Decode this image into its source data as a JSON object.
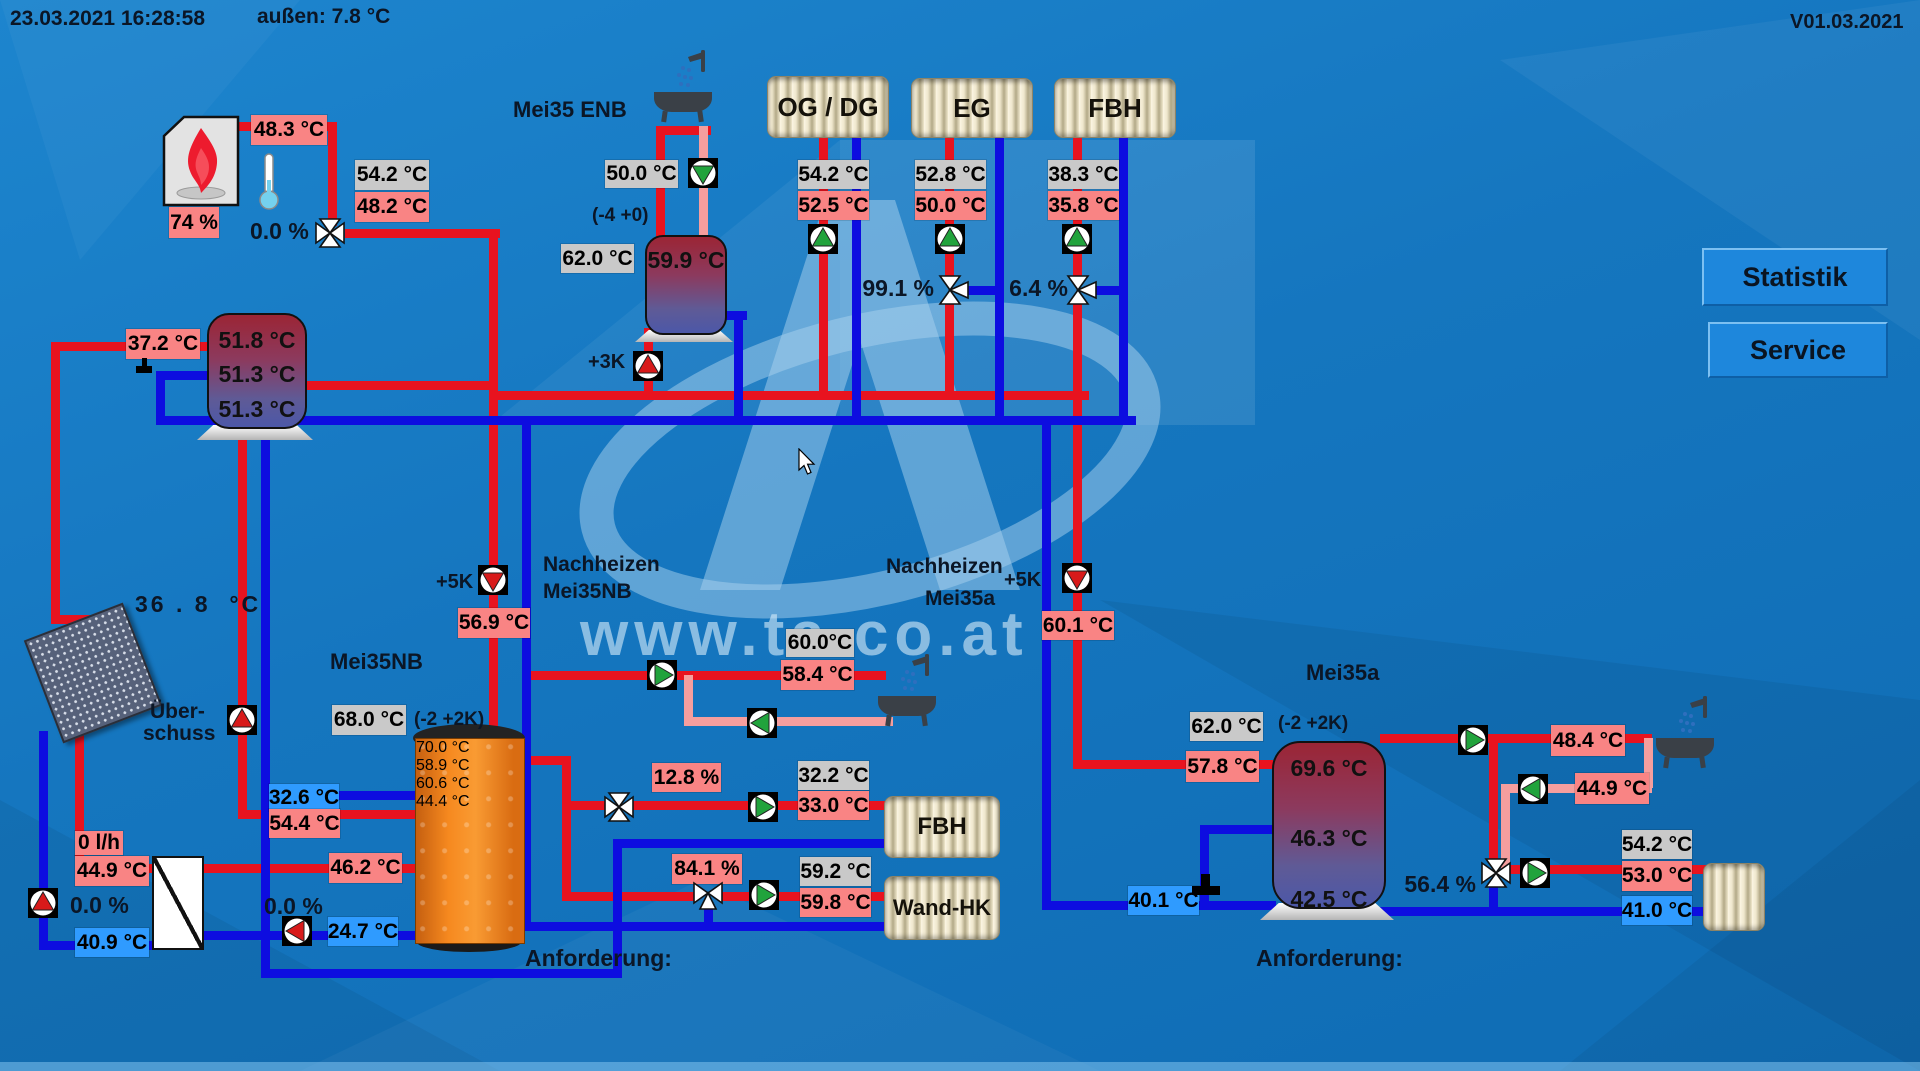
{
  "header": {
    "datetime": "23.03.2021 16:28:58",
    "outside": "außen: 7.8 °C",
    "version": "V01.03.2021"
  },
  "buttons": {
    "statistik": "Statistik",
    "service": "Service"
  },
  "watermark": {
    "url_text": "www.ta.co.at"
  },
  "boiler": {
    "supply": "48.3 °C",
    "power": "74 %",
    "set": "54.2 °C",
    "actual": "48.2 °C",
    "valve": "0.0 %"
  },
  "buffer": {
    "inlet": "37.2 °C",
    "temp_top": "51.8 °C",
    "temp_mid": "51.3 °C",
    "temp_bottom": "51.3 °C"
  },
  "solar": {
    "collector": "36 . 8  °C",
    "surplus_line1": "Über-",
    "surplus_line2": "schuss",
    "flow": "0 l/h",
    "supply": "44.9 °C",
    "pump_pct": "0.0 %",
    "return": "40.9 °C"
  },
  "enb": {
    "title": "Mei35 ENB",
    "tap_set": "50.0 °C",
    "hysteresis": "(-4 +0)",
    "set": "62.0 °C",
    "tank_temp": "59.9 °C",
    "offset": "+3K"
  },
  "nb": {
    "title": "Mei35NB",
    "set": "68.0 °C",
    "hysteresis": "(-2 +2K)",
    "offset": "+5K",
    "supply": "56.9 °C",
    "nachheizen_line1": "Nachheizen",
    "nachheizen_line2": "Mei35NB",
    "temp1": "70.0 °C",
    "temp2": "58.9 °C",
    "temp3": "60.6 °C",
    "temp4": "44.4 °C",
    "in_cold": "32.6 °C",
    "in_hot": "54.4 °C",
    "in_mid": "46.2 °C",
    "out_cold": "24.7 °C",
    "return_pct": "0.0 %",
    "dhw_set": "60.0°C",
    "dhw_actual": "58.4 °C",
    "anforderung": "Anforderung:"
  },
  "circuits": {
    "ogdg": {
      "name": "OG / DG",
      "set": "54.2 °C",
      "actual": "52.5 °C"
    },
    "eg": {
      "name": "EG",
      "set": "52.8 °C",
      "actual": "50.0 °C",
      "valve": "99.1 %"
    },
    "fbh": {
      "name": "FBH",
      "set": "38.3 °C",
      "actual": "35.8 °C",
      "valve": "6.4 %"
    },
    "fbh_mid": {
      "name": "FBH",
      "set": "32.2 °C",
      "actual": "33.0 °C",
      "valve": "12.8 %"
    },
    "wand": {
      "name": "Wand-HK",
      "set": "59.2 °C",
      "actual": "59.8 °C",
      "valve": "84.1 %"
    }
  },
  "a": {
    "title": "Mei35a",
    "nachheizen_line1": "Nachheizen",
    "nachheizen_line2": "Mei35a",
    "offset": "+5K",
    "supply": "60.1 °C",
    "set": "62.0 °C",
    "hysteresis": "(-2 +2K)",
    "inlet": "57.8 °C",
    "temp1": "69.6 °C",
    "temp2": "46.3 °C",
    "temp3": "42.5 °C",
    "return": "40.1 °C",
    "valve": "56.4 %",
    "dhw_supply": "48.4 °C",
    "dhw_return": "44.9 °C",
    "hk_set": "54.2 °C",
    "hk_actual": "53.0 °C",
    "hk_return": "41.0 °C",
    "anforderung": "Anforderung:"
  }
}
